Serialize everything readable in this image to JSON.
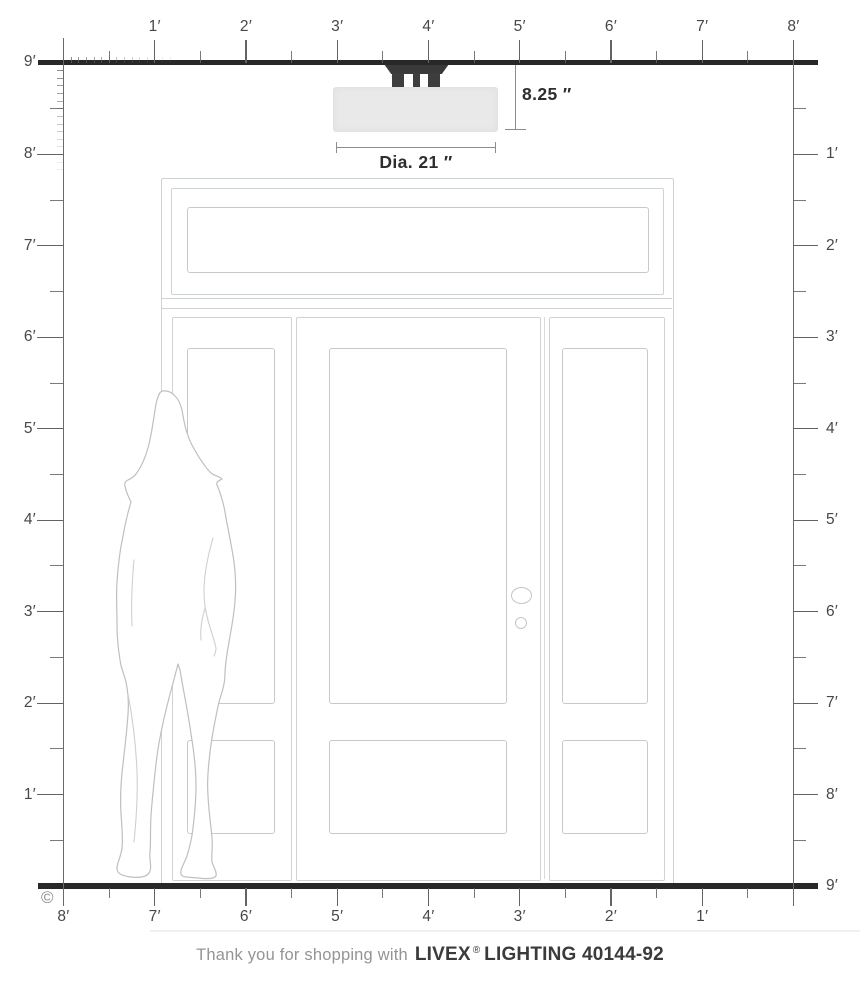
{
  "diagram": {
    "copyright": "©",
    "dimensions": {
      "height": "8.25 ″",
      "diameter": "Dia. 21 ″"
    },
    "rulers": {
      "top": {
        "labels": [
          "1′",
          "2′",
          "3′",
          "4′",
          "5′",
          "6′",
          "7′",
          "8′"
        ]
      },
      "left": {
        "origin_label": "9′",
        "labels": [
          "8′",
          "7′",
          "6′",
          "5′",
          "4′",
          "3′",
          "2′",
          "1′"
        ]
      },
      "right": {
        "labels": [
          "1′",
          "2′",
          "3′",
          "4′",
          "5′",
          "6′",
          "7′",
          "8′"
        ],
        "floor_label": "9′"
      },
      "bottom": {
        "labels": [
          "8′",
          "7′",
          "6′",
          "5′",
          "4′",
          "3′",
          "2′",
          "1′"
        ]
      }
    },
    "colors": {
      "structure_line": "#282828",
      "ruler_line": "#636363",
      "fixture_canopy": "#3a3a3a",
      "fixture_shade": "#e9e9e9",
      "door_line": "#d0d3d4",
      "silhouette_line": "#bfbfbf",
      "dimension_text": "#2e2e2e"
    },
    "footer": {
      "thanks": "Thank you for shopping with",
      "brand": "LIVEX",
      "registered": "®",
      "product_line": "LIGHTING 40144-92"
    }
  }
}
